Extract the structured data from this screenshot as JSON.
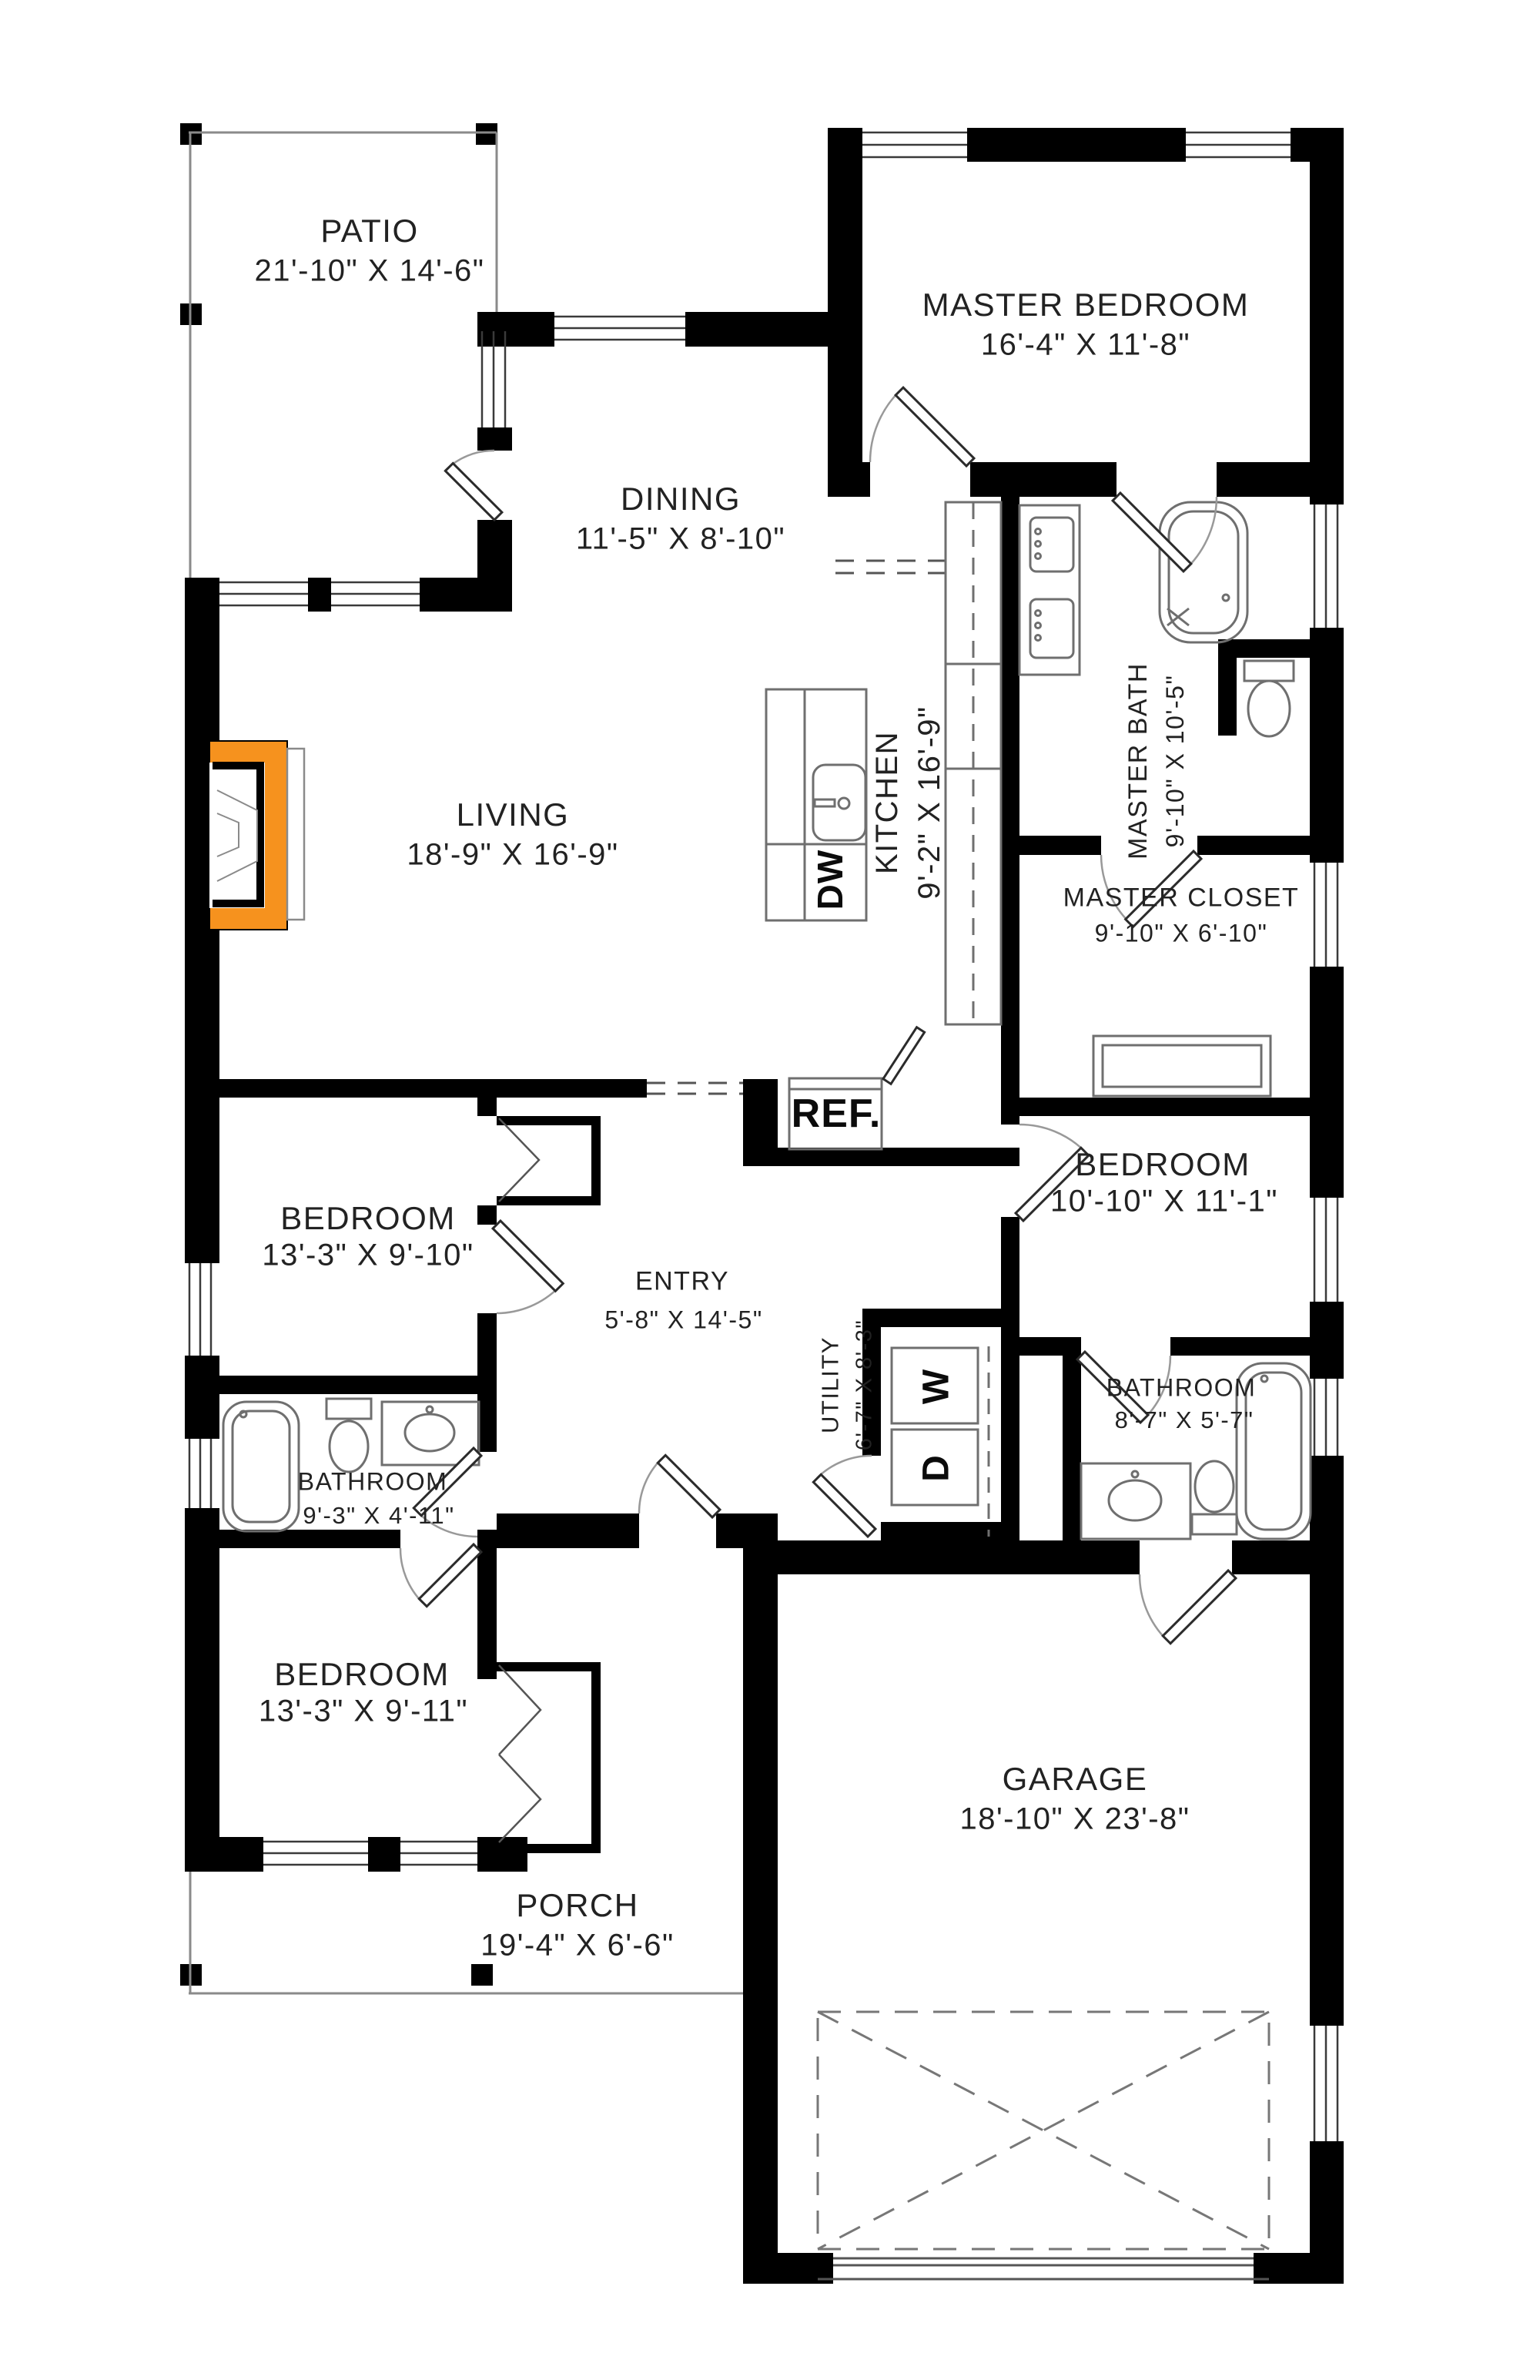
{
  "title": "Single story house floor plan",
  "colors": {
    "wall": "#000000",
    "fixture_line": "#6f6f6f",
    "fireplace_accent": "#F6921E",
    "text": "#222222"
  },
  "rooms": {
    "patio": {
      "label": "PATIO",
      "dims": "21'-10\" X 14'-6\""
    },
    "master_bedroom": {
      "label": "MASTER BEDROOM",
      "dims": "16'-4\" X 11'-8\""
    },
    "dining": {
      "label": "DINING",
      "dims": "11'-5\" X 8'-10\""
    },
    "master_bath": {
      "label": "MASTER BATH",
      "dims": "9'-10\" X 10'-5\""
    },
    "living": {
      "label": "LIVING",
      "dims": "18'-9\" X 16'-9\""
    },
    "kitchen": {
      "label": "KITCHEN",
      "dims": "9'-2\" X 16'-9\""
    },
    "master_closet": {
      "label": "MASTER CLOSET",
      "dims": "9'-10\" X 6'-10\""
    },
    "bedroom_right": {
      "label": "BEDROOM",
      "dims": "10'-10\" X 11'-1\""
    },
    "bedroom_mid_left": {
      "label": "BEDROOM",
      "dims": "13'-3\" X 9'-10\""
    },
    "entry": {
      "label": "ENTRY",
      "dims": "5'-8\" X 14'-5\""
    },
    "utility": {
      "label": "UTILITY",
      "dims": "6'-7\" X 8'-3\""
    },
    "bathroom_right": {
      "label": "BATHROOM",
      "dims": "8'-7\" X 5'-7\""
    },
    "bathroom_left": {
      "label": "BATHROOM",
      "dims": "9'-3\" X 4'-11\""
    },
    "bedroom_bottom": {
      "label": "BEDROOM",
      "dims": "13'-3\" X 9'-11\""
    },
    "garage": {
      "label": "GARAGE",
      "dims": "18'-10\" X 23'-8\""
    },
    "porch": {
      "label": "PORCH",
      "dims": "19'-4\" X 6'-6\""
    }
  },
  "appliances": {
    "refrigerator": "REF.",
    "dishwasher": "DW",
    "washer": "W",
    "dryer": "D"
  }
}
